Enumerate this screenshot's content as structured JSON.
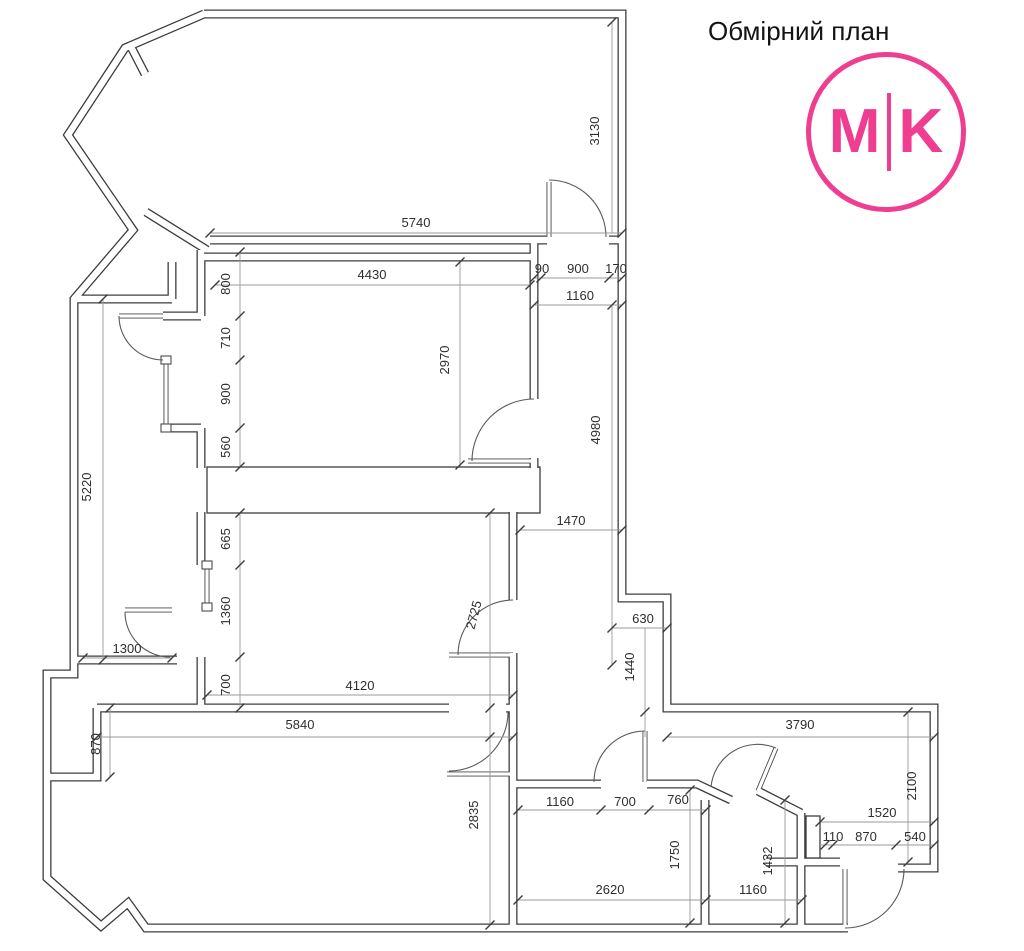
{
  "header": {
    "title": "Обмірний план"
  },
  "logo": {
    "left": "M",
    "right": "K"
  },
  "colors": {
    "accent": "#ef3d8f",
    "line": "#3d3d3d"
  },
  "dims": {
    "d5740": "5740",
    "d3130": "3130",
    "d4430": "4430",
    "d90": "90",
    "d900_door": "900",
    "d170": "170",
    "d1160_hall": "1160",
    "d800": "800",
    "d710": "710",
    "d900_win": "900",
    "d560": "560",
    "d2970": "2970",
    "d4980": "4980",
    "d5220": "5220",
    "d1470": "1470",
    "d665": "665",
    "d1360": "1360",
    "d2725": "2725",
    "d630": "630",
    "d1440": "1440",
    "d1300": "1300",
    "d700_left": "700",
    "d4120": "4120",
    "d5840": "5840",
    "d870_left": "870",
    "d3790": "3790",
    "d2100": "2100",
    "d2835": "2835",
    "d1160_bath": "1160",
    "d700_bath": "700",
    "d760": "760",
    "d1750": "1750",
    "d2620": "2620",
    "d1160_wc": "1160",
    "d1432": "1432",
    "d1520": "1520",
    "d110": "110",
    "d870_entry": "870",
    "d540": "540"
  }
}
